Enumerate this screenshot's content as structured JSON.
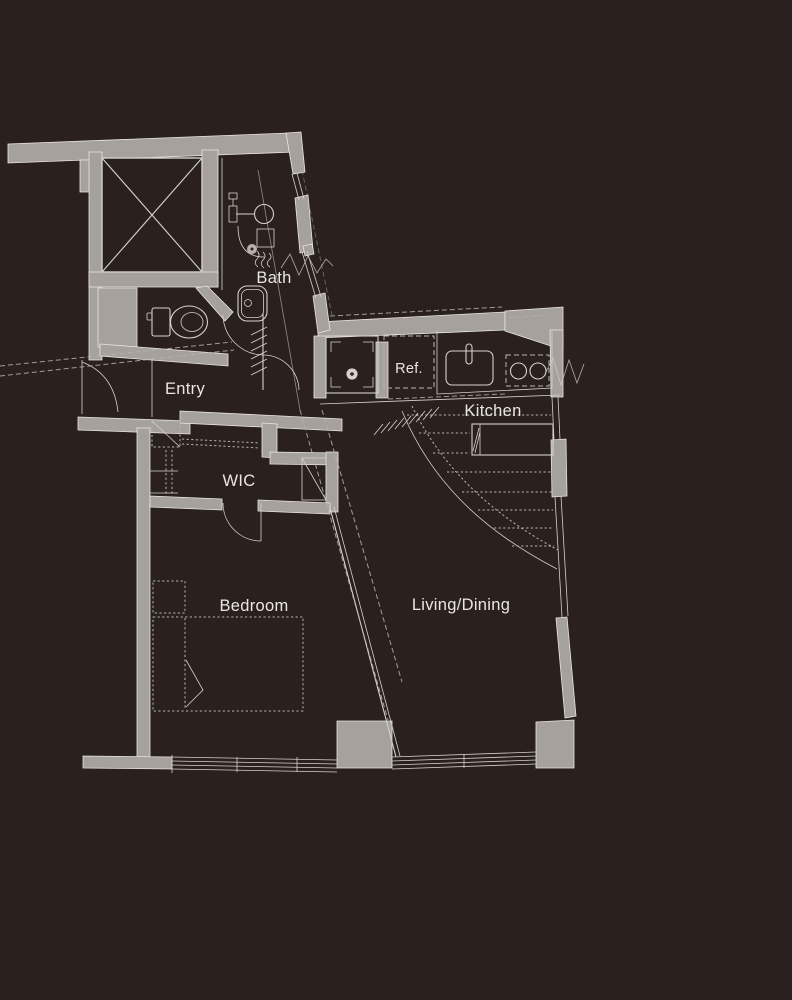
{
  "colors": {
    "background": "#2a211e",
    "wall": "#a7a19e",
    "line": "#d6d1cd",
    "line_soft": "#e9e5e2",
    "dashed": "#b9b3af",
    "text": "#eae6e3"
  },
  "rooms": {
    "bath": {
      "label": "Bath"
    },
    "entry": {
      "label": "Entry"
    },
    "wic": {
      "label": "WIC"
    },
    "bedroom": {
      "label": "Bedroom"
    },
    "living_dining": {
      "label": "Living/Dining"
    },
    "kitchen": {
      "label": "Kitchen"
    },
    "refrigerator": {
      "label": "Ref."
    }
  }
}
